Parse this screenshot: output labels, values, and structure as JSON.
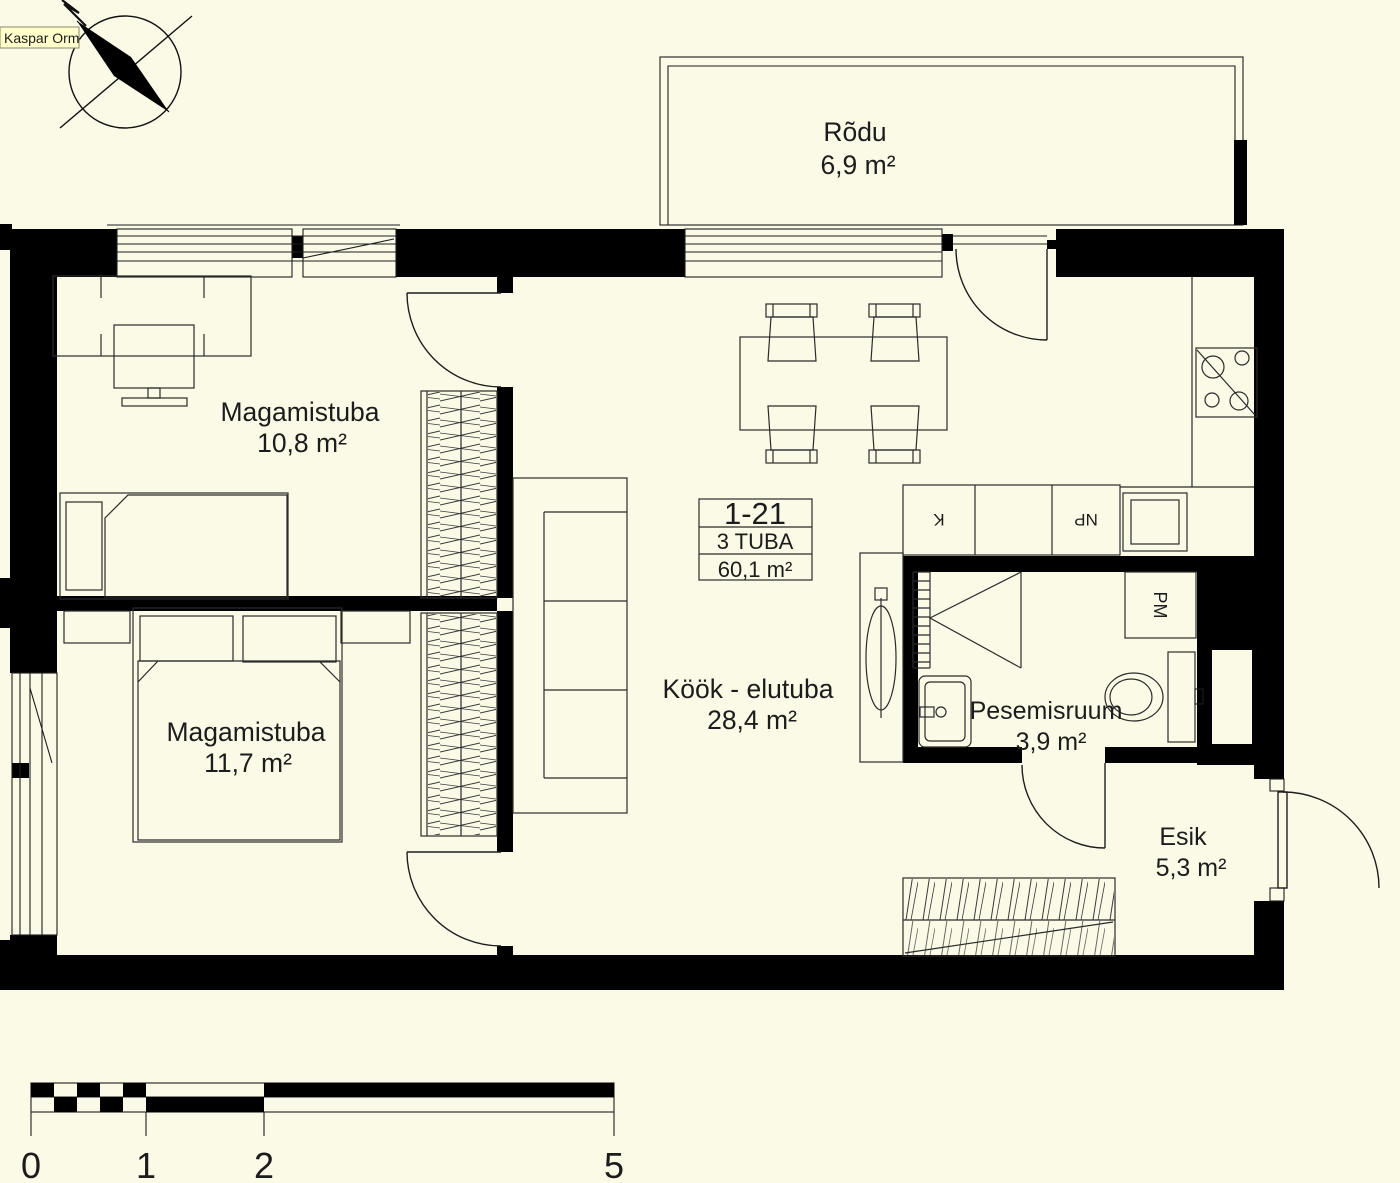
{
  "author_label": "Kaspar Orm",
  "unit": {
    "number": "1-21",
    "type": "3 TUBA",
    "area": "60,1 m²"
  },
  "rooms": {
    "balcony": {
      "name": "Rõdu",
      "area": "6,9 m²"
    },
    "bedroom1": {
      "name": "Magamistuba",
      "area": "10,8 m²"
    },
    "bedroom2": {
      "name": "Magamistuba",
      "area": "11,7 m²"
    },
    "living": {
      "name": "Köök - elutuba",
      "area": "28,4 m²"
    },
    "bathroom": {
      "name": "Pesemisruum",
      "area": "3,9 m²"
    },
    "hallway": {
      "name": "Esik",
      "area": "5,3 m²"
    }
  },
  "appliance_labels": {
    "fridge": "K",
    "dishwasher": "NP",
    "washing_machine": "PM"
  },
  "scale_bar": {
    "labels": [
      "0",
      "1",
      "2",
      "5"
    ]
  },
  "colors": {
    "background": "#FAFAE6",
    "walls": "#000000",
    "lines": "#2b2b2b",
    "text": "#1c1c1c",
    "muted_text": "#8a8a8a",
    "note_background": "#FFFFCC"
  }
}
